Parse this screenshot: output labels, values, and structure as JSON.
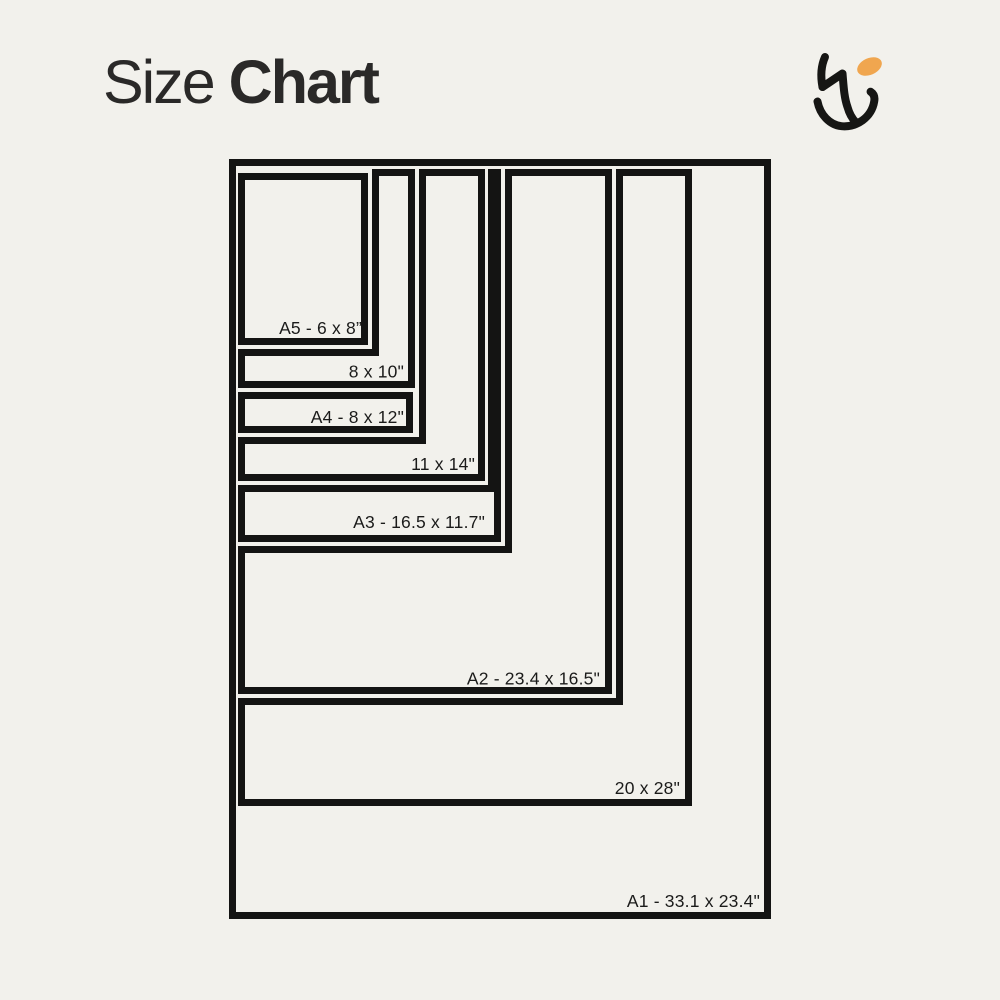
{
  "title": {
    "word_regular": "Size",
    "word_bold": "Chart"
  },
  "logo": {
    "name": "hu-monogram",
    "accent_color": "#F0A64F",
    "ink_color": "#161614"
  },
  "colors": {
    "background": "#F2F1EC",
    "outline_ink": "#141413",
    "title_text": "#2A2928",
    "label_text": "#1B1B1A"
  },
  "chart_data": {
    "type": "table",
    "title": "Size Chart",
    "unit": "inches",
    "layout": "nested-rectangles-anchored-top-left",
    "sizes": [
      {
        "code": "A5",
        "label": "A5 - 6 x 8”",
        "width_in": 6,
        "height_in": 8
      },
      {
        "code": "8x10",
        "label": "8 x 10\"",
        "width_in": 8,
        "height_in": 10
      },
      {
        "code": "A4",
        "label": "A4 - 8 x 12\"",
        "width_in": 8,
        "height_in": 12
      },
      {
        "code": "11x14",
        "label": "11 x 14\"",
        "width_in": 11,
        "height_in": 14
      },
      {
        "code": "A3",
        "label": "A3 - 16.5 x 11.7\"",
        "width_in": 16.5,
        "height_in": 11.7
      },
      {
        "code": "A2",
        "label": "A2 - 23.4 x 16.5\"",
        "width_in": 23.4,
        "height_in": 16.5
      },
      {
        "code": "20x28",
        "label": "20 x 28\"",
        "width_in": 20,
        "height_in": 28
      },
      {
        "code": "A1",
        "label": "A1 - 33.1 x 23.4\"",
        "width_in": 33.1,
        "height_in": 23.4
      }
    ]
  }
}
